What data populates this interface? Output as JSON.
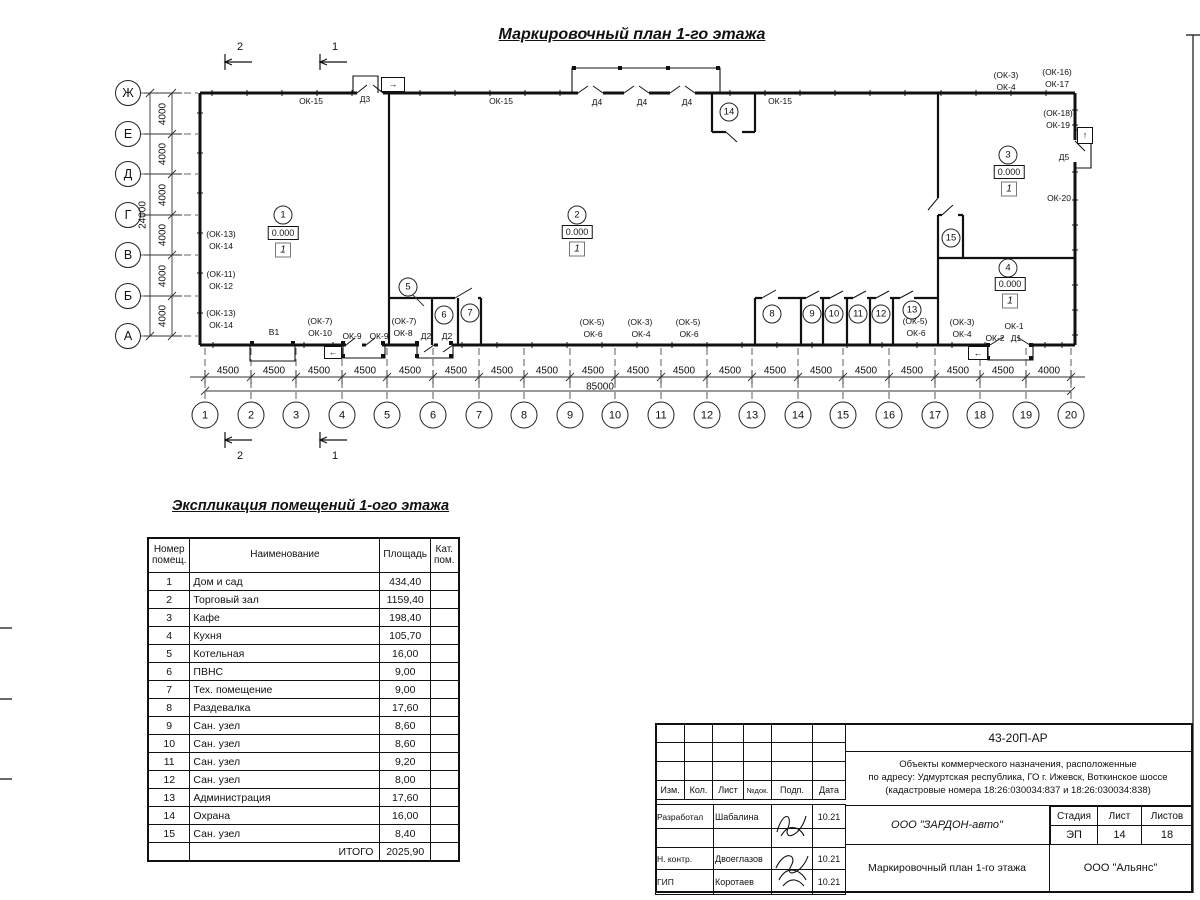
{
  "plan": {
    "title": "Маркировочный план 1-го этажа",
    "elevation_value": "0.000",
    "floor_mark": "1",
    "axis_row_x": 128,
    "axis_col_y": 415,
    "axis_rows": [
      {
        "n": "Ж",
        "y": 93
      },
      {
        "n": "Е",
        "y": 134
      },
      {
        "n": "Д",
        "y": 174
      },
      {
        "n": "Г",
        "y": 215
      },
      {
        "n": "В",
        "y": 255
      },
      {
        "n": "Б",
        "y": 296
      },
      {
        "n": "А",
        "y": 336
      }
    ],
    "axis_cols": [
      {
        "n": "1",
        "x": 205
      },
      {
        "n": "2",
        "x": 251
      },
      {
        "n": "3",
        "x": 296
      },
      {
        "n": "4",
        "x": 342
      },
      {
        "n": "5",
        "x": 387
      },
      {
        "n": "6",
        "x": 433
      },
      {
        "n": "7",
        "x": 479
      },
      {
        "n": "8",
        "x": 524
      },
      {
        "n": "9",
        "x": 570
      },
      {
        "n": "10",
        "x": 615
      },
      {
        "n": "11",
        "x": 661
      },
      {
        "n": "12",
        "x": 707
      },
      {
        "n": "13",
        "x": 752
      },
      {
        "n": "14",
        "x": 798
      },
      {
        "n": "15",
        "x": 843
      },
      {
        "n": "16",
        "x": 889
      },
      {
        "n": "17",
        "x": 935
      },
      {
        "n": "18",
        "x": 980
      },
      {
        "n": "19",
        "x": 1026
      },
      {
        "n": "20",
        "x": 1071
      }
    ],
    "dim_col_label_y": 371,
    "dim_col_labels": [
      {
        "t": "4500",
        "x": 228
      },
      {
        "t": "4500",
        "x": 274
      },
      {
        "t": "4500",
        "x": 319
      },
      {
        "t": "4500",
        "x": 365
      },
      {
        "t": "4500",
        "x": 410
      },
      {
        "t": "4500",
        "x": 456
      },
      {
        "t": "4500",
        "x": 502
      },
      {
        "t": "4500",
        "x": 547
      },
      {
        "t": "4500",
        "x": 593
      },
      {
        "t": "4500",
        "x": 638
      },
      {
        "t": "4500",
        "x": 684
      },
      {
        "t": "4500",
        "x": 730
      },
      {
        "t": "4500",
        "x": 775
      },
      {
        "t": "4500",
        "x": 821
      },
      {
        "t": "4500",
        "x": 866
      },
      {
        "t": "4500",
        "x": 912
      },
      {
        "t": "4500",
        "x": 958
      },
      {
        "t": "4500",
        "x": 1003
      },
      {
        "t": "4000",
        "x": 1049
      }
    ],
    "dim_col_total": {
      "t": "85000",
      "x": 600,
      "y": 387
    },
    "dim_row_label_x": 163,
    "dim_row_labels": [
      {
        "t": "4000",
        "y": 114
      },
      {
        "t": "4000",
        "y": 154
      },
      {
        "t": "4000",
        "y": 195
      },
      {
        "t": "4000",
        "y": 235
      },
      {
        "t": "4000",
        "y": 276
      },
      {
        "t": "4000",
        "y": 316
      }
    ],
    "dim_row_total": {
      "t": "24000",
      "x": 143,
      "y": 215
    },
    "section_marks": [
      {
        "n": "2",
        "x": 240,
        "y": 47
      },
      {
        "n": "1",
        "x": 335,
        "y": 47
      },
      {
        "n": "2",
        "x": 240,
        "y": 456
      },
      {
        "n": "1",
        "x": 335,
        "y": 456
      }
    ],
    "wall_labels": [
      {
        "t": "ОК-15",
        "x": 311,
        "y": 101
      },
      {
        "t": "Д3",
        "x": 365,
        "y": 99
      },
      {
        "t": "ОК-15",
        "x": 501,
        "y": 101
      },
      {
        "t": "Д4",
        "x": 597,
        "y": 102
      },
      {
        "t": "Д4",
        "x": 642,
        "y": 102
      },
      {
        "t": "Д4",
        "x": 687,
        "y": 102
      },
      {
        "t": "ОК-15",
        "x": 780,
        "y": 101
      },
      {
        "t": "(ОК-3)",
        "x": 1006,
        "y": 75
      },
      {
        "t": "ОК-4",
        "x": 1006,
        "y": 87
      },
      {
        "t": "(ОК-16)",
        "x": 1057,
        "y": 72
      },
      {
        "t": "ОК-17",
        "x": 1057,
        "y": 84
      },
      {
        "t": "(ОК-18)",
        "x": 1058,
        "y": 113
      },
      {
        "t": "ОК-19",
        "x": 1058,
        "y": 125
      },
      {
        "t": "Д5",
        "x": 1064,
        "y": 157
      },
      {
        "t": "ОК-20",
        "x": 1059,
        "y": 198
      },
      {
        "t": "(ОК-13)",
        "x": 221,
        "y": 234
      },
      {
        "t": "ОК-14",
        "x": 221,
        "y": 246
      },
      {
        "t": "(ОК-11)",
        "x": 221,
        "y": 274
      },
      {
        "t": "ОК-12",
        "x": 221,
        "y": 286
      },
      {
        "t": "(ОК-13)",
        "x": 221,
        "y": 313
      },
      {
        "t": "ОК-14",
        "x": 221,
        "y": 325
      },
      {
        "t": "В1",
        "x": 274,
        "y": 332
      },
      {
        "t": "(ОК-7)",
        "x": 320,
        "y": 321
      },
      {
        "t": "ОК-10",
        "x": 320,
        "y": 333
      },
      {
        "t": "ОК-9",
        "x": 352,
        "y": 336
      },
      {
        "t": "ОК-9",
        "x": 379,
        "y": 336
      },
      {
        "t": "(ОК-7)",
        "x": 404,
        "y": 321
      },
      {
        "t": "ОК-8",
        "x": 403,
        "y": 333
      },
      {
        "t": "Д2",
        "x": 426,
        "y": 336
      },
      {
        "t": "Д2",
        "x": 447,
        "y": 336
      },
      {
        "t": "(ОК-5)",
        "x": 592,
        "y": 322
      },
      {
        "t": "ОК-6",
        "x": 593,
        "y": 334
      },
      {
        "t": "(ОК-3)",
        "x": 640,
        "y": 322
      },
      {
        "t": "ОК-4",
        "x": 641,
        "y": 334
      },
      {
        "t": "(ОК-5)",
        "x": 688,
        "y": 322
      },
      {
        "t": "ОК-6",
        "x": 689,
        "y": 334
      },
      {
        "t": "(ОК-5)",
        "x": 915,
        "y": 321
      },
      {
        "t": "ОК-6",
        "x": 916,
        "y": 333
      },
      {
        "t": "(ОК-3)",
        "x": 962,
        "y": 322
      },
      {
        "t": "ОК-4",
        "x": 962,
        "y": 334
      },
      {
        "t": "ОК-2",
        "x": 995,
        "y": 338
      },
      {
        "t": "ОК-1",
        "x": 1014,
        "y": 326
      },
      {
        "t": "Д1",
        "x": 1016,
        "y": 338
      }
    ],
    "room_markers": [
      {
        "n": "1",
        "x": 283,
        "y": 215
      },
      {
        "n": "2",
        "x": 577,
        "y": 215
      },
      {
        "n": "3",
        "x": 1008,
        "y": 155
      },
      {
        "n": "4",
        "x": 1008,
        "y": 268
      },
      {
        "n": "5",
        "x": 408,
        "y": 287
      },
      {
        "n": "6",
        "x": 444,
        "y": 315
      },
      {
        "n": "7",
        "x": 470,
        "y": 313
      },
      {
        "n": "8",
        "x": 772,
        "y": 314
      },
      {
        "n": "9",
        "x": 812,
        "y": 314
      },
      {
        "n": "10",
        "x": 834,
        "y": 314
      },
      {
        "n": "11",
        "x": 858,
        "y": 314
      },
      {
        "n": "12",
        "x": 881,
        "y": 314
      },
      {
        "n": "13",
        "x": 912,
        "y": 310
      },
      {
        "n": "14",
        "x": 729,
        "y": 112
      },
      {
        "n": "15",
        "x": 951,
        "y": 238
      }
    ],
    "elevations": [
      {
        "x": 283,
        "y": 233
      },
      {
        "x": 577,
        "y": 232
      },
      {
        "x": 1009,
        "y": 172
      },
      {
        "x": 1010,
        "y": 284
      }
    ],
    "arrow_boxes": [
      {
        "g": "→",
        "x": 381,
        "y": 77,
        "w": 22,
        "h": 13
      },
      {
        "g": "↑",
        "x": 1077,
        "y": 127,
        "w": 14,
        "h": 15
      },
      {
        "g": "←",
        "x": 324,
        "y": 346,
        "w": 16,
        "h": 11
      },
      {
        "g": "←",
        "x": 968,
        "y": 346,
        "w": 18,
        "h": 12
      }
    ]
  },
  "explication": {
    "title": "Экспликация помещений 1-ого этажа",
    "columns": [
      "Номер помещ.",
      "Наименование",
      "Площадь",
      "Кат. пом."
    ],
    "rows": [
      {
        "num": "1",
        "name": "Дом и сад",
        "area": "434,40",
        "cat": ""
      },
      {
        "num": "2",
        "name": "Торговый зал",
        "area": "1159,40",
        "cat": ""
      },
      {
        "num": "3",
        "name": "Кафе",
        "area": "198,40",
        "cat": ""
      },
      {
        "num": "4",
        "name": "Кухня",
        "area": "105,70",
        "cat": ""
      },
      {
        "num": "5",
        "name": "Котельная",
        "area": "16,00",
        "cat": ""
      },
      {
        "num": "6",
        "name": "ПВНС",
        "area": "9,00",
        "cat": ""
      },
      {
        "num": "7",
        "name": "Тех. помещение",
        "area": "9,00",
        "cat": ""
      },
      {
        "num": "8",
        "name": "Раздевалка",
        "area": "17,60",
        "cat": ""
      },
      {
        "num": "9",
        "name": "Сан. узел",
        "area": "8,60",
        "cat": ""
      },
      {
        "num": "10",
        "name": "Сан. узел",
        "area": "8,60",
        "cat": ""
      },
      {
        "num": "11",
        "name": "Сан. узел",
        "area": "9,20",
        "cat": ""
      },
      {
        "num": "12",
        "name": "Сан. узел",
        "area": "8,00",
        "cat": ""
      },
      {
        "num": "13",
        "name": "Администрация",
        "area": "17,60",
        "cat": ""
      },
      {
        "num": "14",
        "name": "Охрана",
        "area": "16,00",
        "cat": ""
      },
      {
        "num": "15",
        "name": "Сан. узел",
        "area": "8,40",
        "cat": ""
      }
    ],
    "total_label": "ИТОГО",
    "total_value": "2025,90"
  },
  "titleblock": {
    "code": "43-20П-АР",
    "description_lines": [
      "Объекты коммерческого назначения, расположенные",
      "по адресу: Удмуртская республика, ГО г. Ижевск, Воткинское шоссе",
      "(кадастровые номера 18:26:030034:837 и 18:26:030034:838)"
    ],
    "revision_cols": [
      "Изм.",
      "Кол.",
      "Лист",
      "№док.",
      "Подп.",
      "Дата"
    ],
    "signature_rows": [
      {
        "role": "Разработал",
        "name": "Шабалина",
        "date": "10.21"
      },
      {
        "role": "",
        "name": "",
        "date": ""
      },
      {
        "role": "Н. контр.",
        "name": "Двоеглазов",
        "date": "10.21"
      },
      {
        "role": "ГИП",
        "name": "Коротаев",
        "date": "10.21"
      }
    ],
    "organization": "ООО \"ЗАРДОН-авто\"",
    "sheet_title": "Маркировочный план 1-го этажа",
    "stage_cols": [
      "Стадия",
      "Лист",
      "Листов"
    ],
    "stage_values": [
      "ЭП",
      "14",
      "18"
    ],
    "company": "ООО \"Альянс\""
  }
}
